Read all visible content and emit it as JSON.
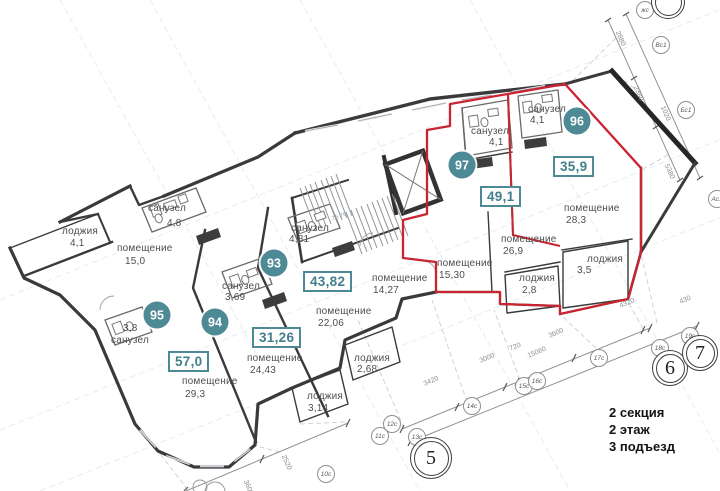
{
  "plan": {
    "info": [
      "2 секция",
      "2 этаж",
      "3 подъезд"
    ],
    "stair_note": "76 76",
    "colors": {
      "accent_teal": "#4e8a95",
      "area_text_teal": "#41808b",
      "highlight_red": "#ca2430",
      "wall_dark": "#3a3a3a",
      "label_gray": "#4e4e4e"
    },
    "apartments": [
      {
        "number": "97",
        "total_area": "49,1",
        "badge": {
          "x": 462,
          "y": 165
        },
        "box": {
          "x": 480,
          "y": 186
        },
        "rooms": [
          {
            "name": "санузел",
            "area": "4,1",
            "nx": 471,
            "ny": 126,
            "ax": 489,
            "ay": 137
          },
          {
            "name": "помещение",
            "area": "15,30",
            "nx": 437,
            "ny": 258,
            "ax": 439,
            "ay": 270
          },
          {
            "name": "помещение",
            "area": "26,9",
            "nx": 501,
            "ny": 234,
            "ax": 503,
            "ay": 246
          },
          {
            "name": "лоджия",
            "area": "2,8",
            "nx": 519,
            "ny": 273,
            "ax": 522,
            "ay": 285
          }
        ]
      },
      {
        "number": "96",
        "total_area": "35,9",
        "badge": {
          "x": 577,
          "y": 121
        },
        "box": {
          "x": 553,
          "y": 156
        },
        "rooms": [
          {
            "name": "санузел",
            "area": "4,1",
            "nx": 528,
            "ny": 104,
            "ax": 530,
            "ay": 115
          },
          {
            "name": "помещение",
            "area": "28,3",
            "nx": 564,
            "ny": 203,
            "ax": 566,
            "ay": 215
          },
          {
            "name": "лоджия",
            "area": "3,5",
            "nx": 587,
            "ny": 254,
            "ax": 577,
            "ay": 265
          }
        ]
      },
      {
        "number": "93",
        "total_area": "43,82",
        "badge": {
          "x": 274,
          "y": 263
        },
        "box": {
          "x": 303,
          "y": 271
        },
        "rooms": [
          {
            "name": "санузел",
            "area": "4,81",
            "nx": 291,
            "ny": 223,
            "ax": 289,
            "ay": 234
          },
          {
            "name": "помещение",
            "area": "22,06",
            "nx": 316,
            "ny": 306,
            "ax": 318,
            "ay": 318
          },
          {
            "name": "помещение",
            "area": "14,27",
            "nx": 372,
            "ny": 273,
            "ax": 373,
            "ay": 285
          },
          {
            "name": "лоджия",
            "area": "2,68",
            "nx": 354,
            "ny": 353,
            "ax": 357,
            "ay": 364
          }
        ]
      },
      {
        "number": "94",
        "total_area": "31,26",
        "badge": {
          "x": 215,
          "y": 322
        },
        "box": {
          "x": 252,
          "y": 327
        },
        "rooms": [
          {
            "name": "санузел",
            "area": "3,69",
            "nx": 222,
            "ny": 281,
            "ax": 225,
            "ay": 292
          },
          {
            "name": "помещение",
            "area": "24,43",
            "nx": 247,
            "ny": 353,
            "ax": 250,
            "ay": 365
          },
          {
            "name": "лоджия",
            "area": "3,14",
            "nx": 307,
            "ny": 391,
            "ax": 308,
            "ay": 403
          }
        ]
      },
      {
        "number": "95",
        "total_area": "57,0",
        "badge": {
          "x": 157,
          "y": 315
        },
        "box": {
          "x": 168,
          "y": 351
        },
        "rooms": [
          {
            "name": "лоджия",
            "area": "4,1",
            "nx": 62,
            "ny": 226,
            "ax": 70,
            "ay": 238
          },
          {
            "name": "помещение",
            "area": "15,0",
            "nx": 117,
            "ny": 243,
            "ax": 125,
            "ay": 256
          },
          {
            "name": "санузел",
            "area": "4,8",
            "nx": 148,
            "ny": 203,
            "ax": 167,
            "ay": 218
          },
          {
            "name": "санузел",
            "area": "3,8",
            "nx": 111,
            "ny": 335,
            "ax": 123,
            "ay": 323
          },
          {
            "name": "помещение",
            "area": "29,3",
            "nx": 182,
            "ny": 376,
            "ax": 185,
            "ay": 389
          }
        ]
      }
    ],
    "markers_small": [
      {
        "t": "жс",
        "x": 645,
        "y": 10
      },
      {
        "t": "Вс1",
        "x": 661,
        "y": 45
      },
      {
        "t": "Бс1",
        "x": 686,
        "y": 110
      },
      {
        "t": "Ас1",
        "x": 717,
        "y": 199
      },
      {
        "t": "10с",
        "x": 326,
        "y": 474
      },
      {
        "t": "11с",
        "x": 380,
        "y": 436
      },
      {
        "t": "12с",
        "x": 392,
        "y": 424
      },
      {
        "t": "13с",
        "x": 417,
        "y": 437
      },
      {
        "t": "14с",
        "x": 472,
        "y": 406
      },
      {
        "t": "15с",
        "x": 524,
        "y": 386
      },
      {
        "t": "16с",
        "x": 537,
        "y": 381
      },
      {
        "t": "17с",
        "x": 599,
        "y": 358
      },
      {
        "t": "18с",
        "x": 660,
        "y": 348
      },
      {
        "t": "19с",
        "x": 690,
        "y": 336
      }
    ],
    "markers_large": [
      {
        "t": "5",
        "x": 431,
        "y": 458,
        "s": 40
      },
      {
        "t": "6",
        "x": 670,
        "y": 368,
        "s": 34
      },
      {
        "t": "7",
        "x": 700,
        "y": 353,
        "s": 34
      },
      {
        "t": "",
        "x": 668,
        "y": 2,
        "s": 32
      }
    ],
    "dimensions": [
      {
        "t": "3420",
        "x": 424,
        "y": 381,
        "r": -23
      },
      {
        "t": "3000",
        "x": 480,
        "y": 358,
        "r": -23
      },
      {
        "t": "720",
        "x": 510,
        "y": 346,
        "r": -23
      },
      {
        "t": "15060",
        "x": 528,
        "y": 353,
        "r": -23
      },
      {
        "t": "3600",
        "x": 549,
        "y": 333,
        "r": -23
      },
      {
        "t": "4320",
        "x": 620,
        "y": 303,
        "r": -23
      },
      {
        "t": "430",
        "x": 680,
        "y": 299,
        "r": -23
      },
      {
        "t": "2520",
        "x": 283,
        "y": 452,
        "r": 66
      },
      {
        "t": "3600",
        "x": 245,
        "y": 477,
        "r": 66
      },
      {
        "t": "2880",
        "x": 617,
        "y": 28,
        "r": 66
      },
      {
        "t": "2380",
        "x": 635,
        "y": 83,
        "r": 66
      },
      {
        "t": "1020",
        "x": 662,
        "y": 103,
        "r": 66
      },
      {
        "t": "5380",
        "x": 666,
        "y": 161,
        "r": 66
      }
    ]
  }
}
